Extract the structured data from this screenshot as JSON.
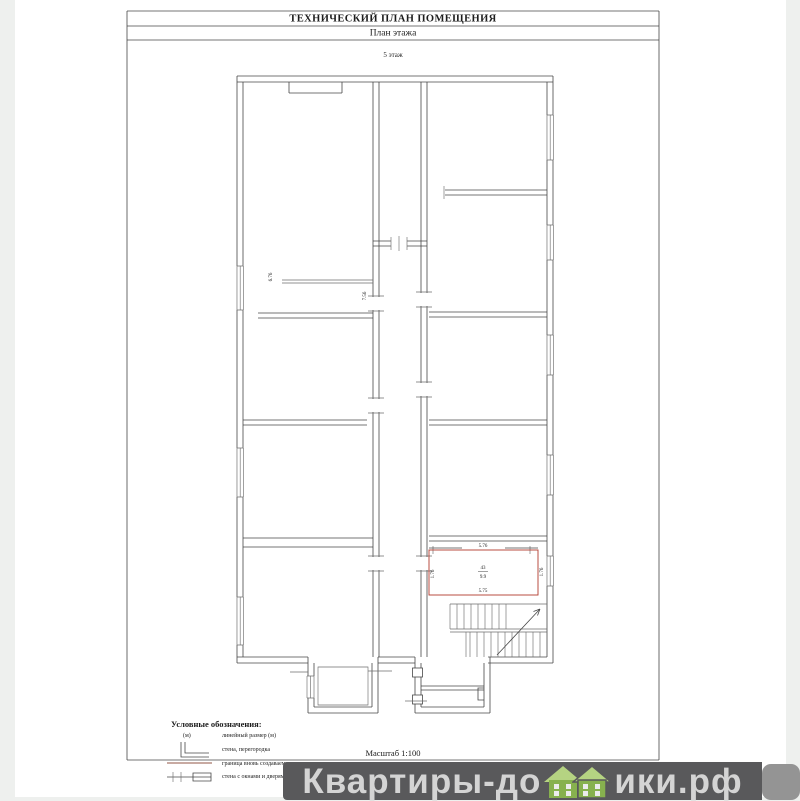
{
  "document": {
    "title": "ТЕХНИЧЕСКИЙ ПЛАН ПОМЕЩЕНИЯ",
    "subtitle": "План этажа",
    "floor_label": "5 этаж",
    "scale_label": "Масштаб 1:100"
  },
  "plan": {
    "labels": {
      "dim_room_left": "6.76",
      "dim_room_right": "7.56",
      "red_top": "5.76",
      "red_bottom": "5.75",
      "red_left": "1.76",
      "red_right": "1.76",
      "red_room_number": "43",
      "red_room_area": "9.9"
    },
    "colors": {
      "wall": "#474747",
      "new_boundary": "#b23b2e"
    }
  },
  "legend": {
    "title": "Условные обозначения:",
    "items": [
      {
        "symbol_text": "(м)",
        "label": "линейный размер (м)"
      },
      {
        "label": "стена, перегородка"
      },
      {
        "label": "граница вновь создаваемого помещения"
      },
      {
        "label": "стена с окнами и дверями"
      }
    ]
  },
  "watermark": {
    "text_before": "Квартиры-до",
    "text_after": "ики.рф",
    "band_color": "#59595b",
    "text_color": "#d4d4d4",
    "house_green_roof": "#b5d382",
    "house_green_body": "#87b14e"
  }
}
